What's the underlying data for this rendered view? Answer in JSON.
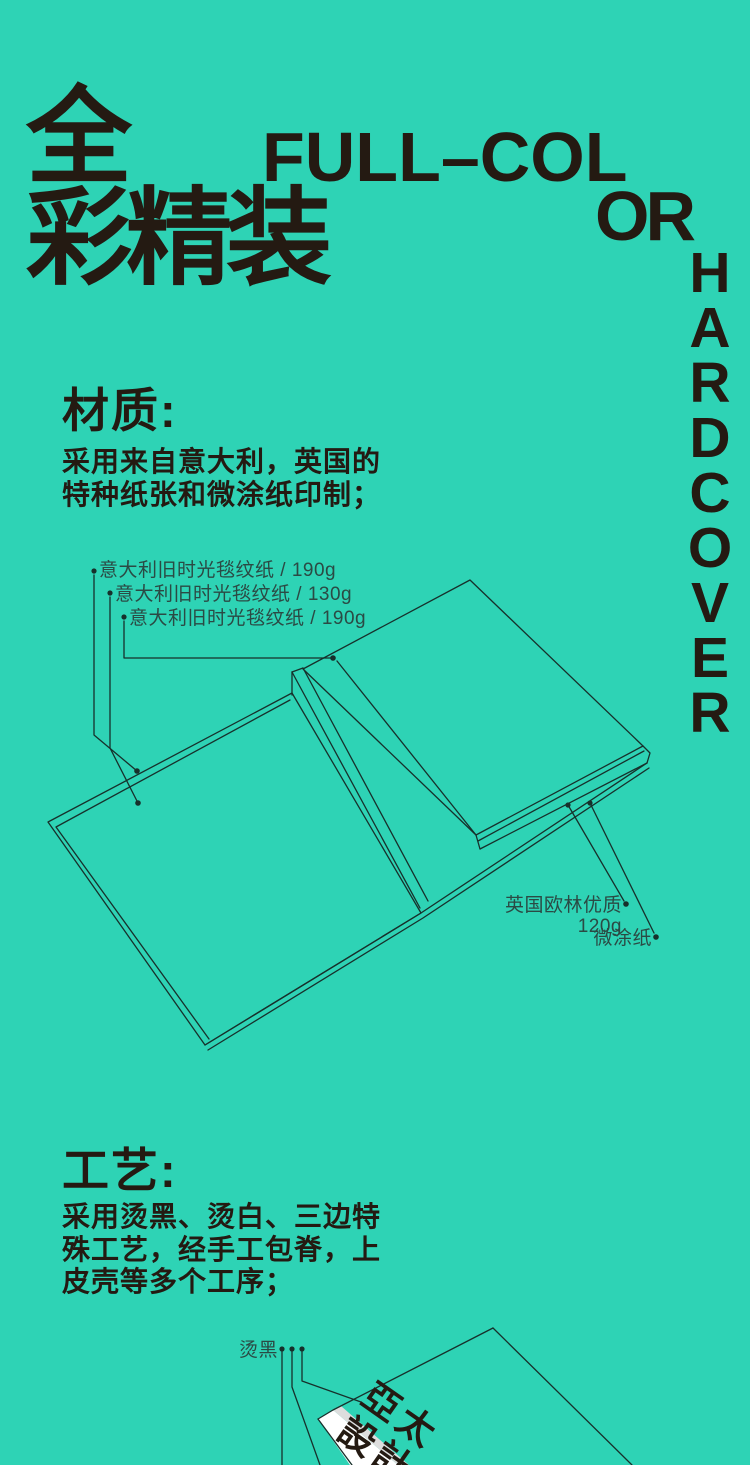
{
  "colors": {
    "background": "#2ed3b5",
    "ink": "#241a12",
    "muted_label": "#2b4a44",
    "line": "#17302b",
    "spine_white": "#ffffff",
    "spine_gray": "#dddddd"
  },
  "header": {
    "cjk_headline": "全\n彩精装",
    "latin_line1": "FULL–COL",
    "latin_line2": "OR",
    "vertical_word": "HARDCOVER",
    "vertical_letters": [
      "H",
      "A",
      "R",
      "D",
      "C",
      "O",
      "V",
      "E",
      "R"
    ]
  },
  "material": {
    "heading": "材质:",
    "body": "采用来自意大利，英国的\n特种纸张和微涂纸印制；",
    "labels_left": [
      "意大利旧时光毯纹纸 / 190g",
      "意大利旧时光毯纹纸 / 130g",
      "意大利旧时光毯纹纸 / 190g"
    ],
    "labels_right": [
      "英国欧林优质120g",
      "微涂纸"
    ]
  },
  "process": {
    "heading": "工艺:",
    "body": "采用烫黑、烫白、三边特\n殊工艺，经手工包脊，上\n皮壳等多个工序；",
    "stamp_label": "烫黑",
    "book_title": "亞太\n設計"
  }
}
